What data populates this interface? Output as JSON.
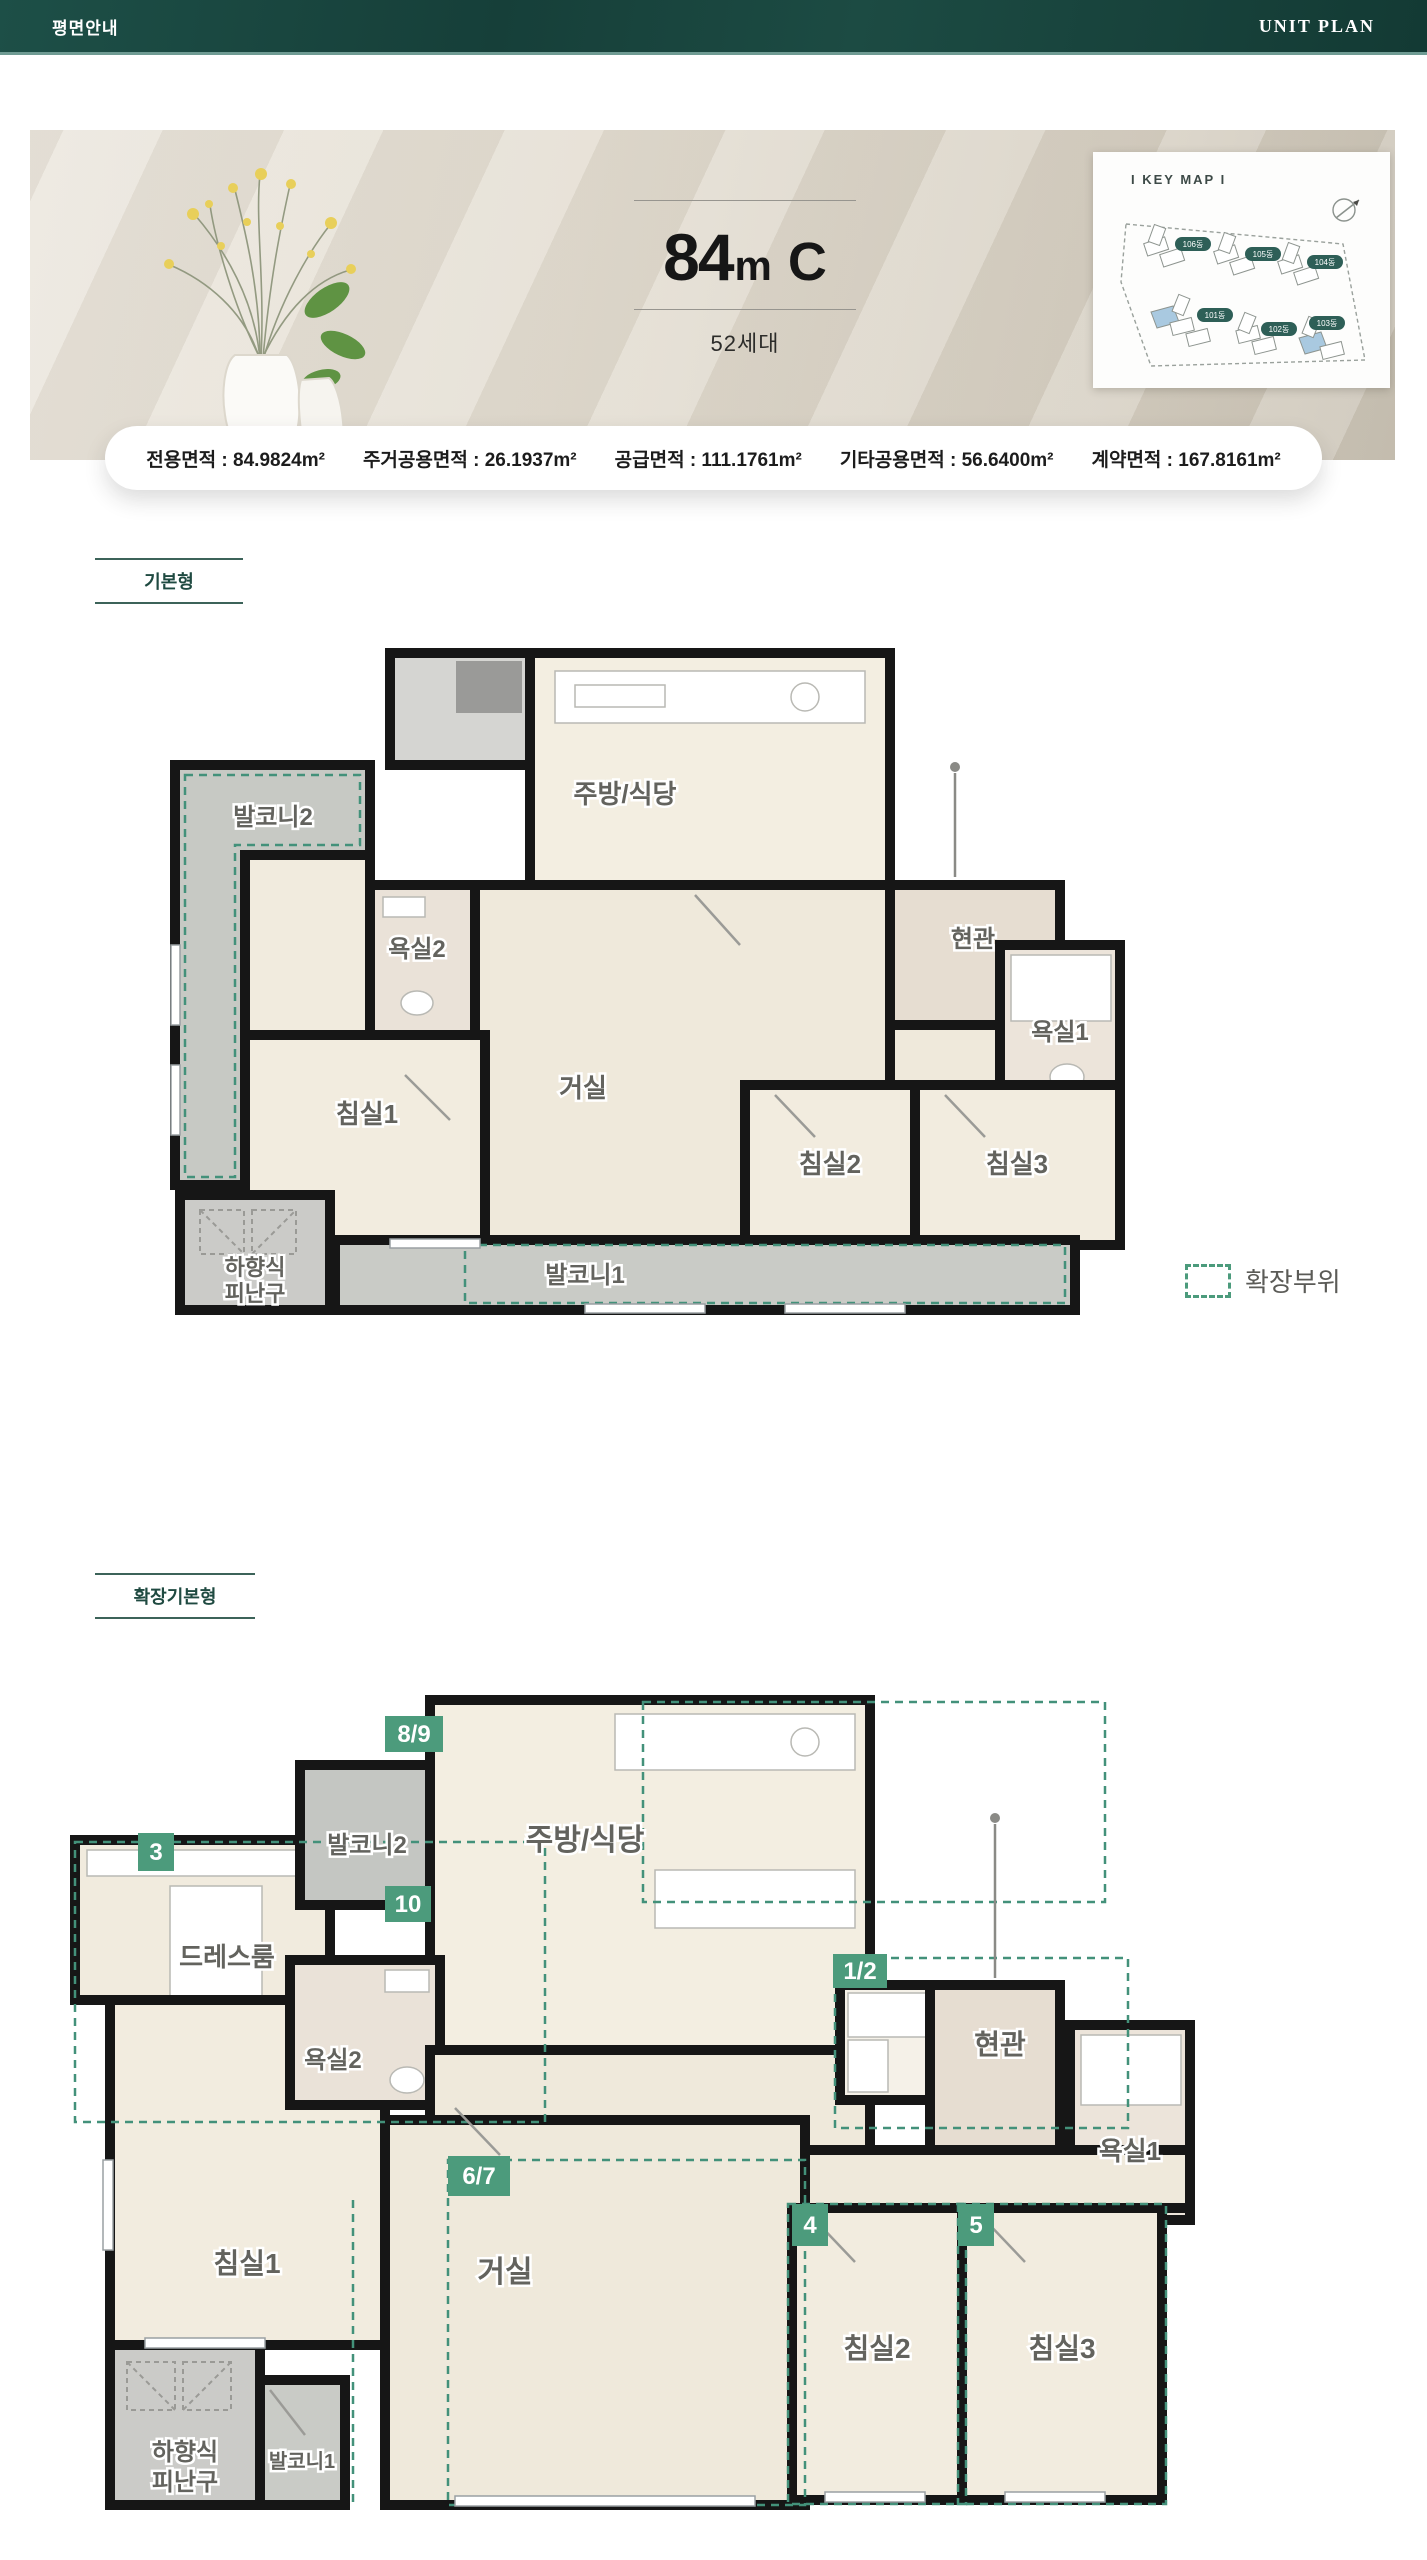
{
  "colors": {
    "header_teal": "#17463e",
    "accent_green": "#4c9b7c",
    "dash_green": "#43917a",
    "banner_beige": "#e3ddd1"
  },
  "header": {
    "title": "평면안내",
    "subtitle": "UNIT PLAN"
  },
  "banner": {
    "title": {
      "num": "84",
      "m": "m",
      "sup": "2",
      "c": "C"
    },
    "households": "52세대",
    "keymap": {
      "title": "I KEY MAP I",
      "buildings": [
        "106동",
        "105동",
        "104동",
        "101동",
        "102동",
        "103동"
      ]
    }
  },
  "areas": [
    "전용면적 : 84.9824m²",
    "주거공용면적 : 26.1937m²",
    "공급면적 : 111.1761m²",
    "기타공용면적 : 56.6400m²",
    "계약면적 : 167.8161m²"
  ],
  "sections": [
    {
      "label": "기본형"
    },
    {
      "label": "확장기본형"
    }
  ],
  "legend": {
    "label": "확장부위"
  },
  "plan_basic": {
    "rooms": {
      "balcony2": "발코니2",
      "bath2": "욕실2",
      "kitchen": "주방/식당",
      "bed1": "침실1",
      "living": "거실",
      "entrance": "현관",
      "bath1": "욕실1",
      "bed2": "침실2",
      "bed3": "침실3",
      "balcony1": "발코니1",
      "escape_l1": "하향식",
      "escape_l2": "피난구"
    }
  },
  "plan_extended": {
    "rooms": {
      "dressroom": "드레스룸",
      "balcony2": "발코니2",
      "kitchen": "주방/식당",
      "bath2": "욕실2",
      "entrance": "현관",
      "bath1": "욕실1",
      "bed1": "침실1",
      "living": "거실",
      "bed2": "침실2",
      "bed3": "침실3",
      "balcony1": "발코니1",
      "escape_l1": "하향식",
      "escape_l2": "피난구"
    },
    "badges": {
      "b12": "1/2",
      "b3": "3",
      "b4": "4",
      "b5": "5",
      "b67": "6/7",
      "b89": "8/9",
      "b10": "10"
    }
  }
}
